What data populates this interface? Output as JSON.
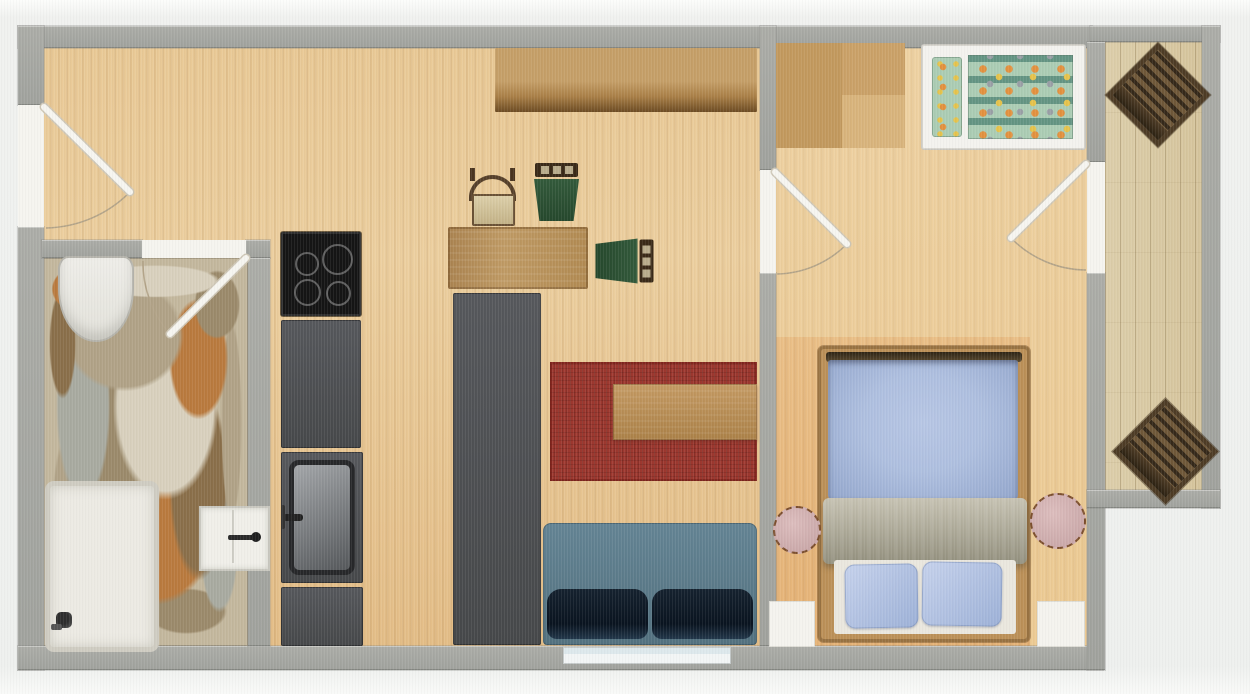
{
  "scene": {
    "type": "apartment-floor-plan",
    "width": 1250,
    "height": 694,
    "visible_text": "none"
  },
  "palette": {
    "floorA": "#e9c996",
    "floorB": "#e3bd87",
    "bedFloorA": "#eed2a3",
    "bedFloorB": "#ecca93",
    "rugOrangeA": "#eabf87",
    "rugOrangeB": "#e5b377",
    "balcony": "#d5c49c",
    "stoneBase": "#c3b79d",
    "st1": "#b0a287",
    "st2": "#9b8a6b",
    "st3": "#b97a3e",
    "st4": "#a8aaa0",
    "st5": "#d8d0bd",
    "st6": "#8a6f4a",
    "rugRed": "#9d382f",
    "bedFrame": "#bb9058",
    "duvetA": "#aebfdf",
    "duvetB": "#93a6cc",
    "nightOutline": "#7c4f2e",
    "childMint": "#abccb4",
    "childOrange": "#e2913f",
    "childYellow": "#e5c34c",
    "childGray": "#9aa0a6",
    "arc": "#b3a489"
  },
  "rooms": [
    {
      "name": "living-room-floor",
      "type": "floor-wood",
      "x": 42,
      "y": 48,
      "w": 718,
      "h": 598
    },
    {
      "name": "bathroom-floor",
      "type": "floor-stone",
      "x": 42,
      "y": 258,
      "w": 206,
      "h": 388
    },
    {
      "name": "bedroom-floor",
      "type": "floor-bedroom",
      "x": 776,
      "y": 42,
      "w": 311,
      "h": 604
    },
    {
      "name": "bedroom-rug",
      "type": "floor-orange",
      "x": 776,
      "y": 337,
      "w": 254,
      "h": 309
    },
    {
      "name": "balcony-floor",
      "type": "floor-balcony",
      "x": 1105,
      "y": 42,
      "w": 97,
      "h": 448
    }
  ],
  "walls": [
    {
      "name": "wall-top",
      "x": 18,
      "y": 26,
      "w": 1074,
      "h": 22
    },
    {
      "name": "wall-top-balcony",
      "x": 1090,
      "y": 26,
      "w": 130,
      "h": 16
    },
    {
      "name": "wall-left-upper",
      "x": 18,
      "y": 26,
      "w": 26,
      "h": 79
    },
    {
      "name": "wall-left-lower",
      "x": 18,
      "y": 227,
      "w": 26,
      "h": 443
    },
    {
      "name": "wall-bottom",
      "x": 18,
      "y": 646,
      "w": 1085,
      "h": 24
    },
    {
      "name": "wall-bathroom-top-left",
      "x": 42,
      "y": 240,
      "w": 100,
      "h": 18
    },
    {
      "name": "wall-bathroom-top-right",
      "x": 246,
      "y": 240,
      "w": 24,
      "h": 18
    },
    {
      "name": "wall-bathroom-right",
      "x": 248,
      "y": 258,
      "w": 22,
      "h": 388
    },
    {
      "name": "wall-bedroom-upper",
      "x": 760,
      "y": 26,
      "w": 16,
      "h": 144
    },
    {
      "name": "wall-bedroom-lower",
      "x": 760,
      "y": 273,
      "w": 16,
      "h": 373
    },
    {
      "name": "wall-balcony-upper",
      "x": 1087,
      "y": 42,
      "w": 18,
      "h": 120
    },
    {
      "name": "wall-balcony-lower",
      "x": 1087,
      "y": 273,
      "w": 18,
      "h": 397
    },
    {
      "name": "wall-balcony-right",
      "x": 1202,
      "y": 26,
      "w": 18,
      "h": 482
    },
    {
      "name": "wall-balcony-bottom",
      "x": 1087,
      "y": 490,
      "w": 133,
      "h": 18
    }
  ],
  "door_gaps": [
    {
      "name": "entrance-door-opening",
      "x": 18,
      "y": 105,
      "w": 26,
      "h": 122
    },
    {
      "name": "bathroom-door-opening",
      "x": 142,
      "y": 240,
      "w": 104,
      "h": 18
    },
    {
      "name": "bedroom-door-opening",
      "x": 760,
      "y": 170,
      "w": 16,
      "h": 103
    },
    {
      "name": "balcony-door-opening",
      "x": 1087,
      "y": 162,
      "w": 18,
      "h": 111
    }
  ],
  "windows": [
    {
      "name": "living-room-window",
      "type": "window",
      "x": 563,
      "y": 647,
      "w": 168,
      "h": 17
    },
    {
      "name": "bedroom-window-left",
      "type": "window-sq",
      "x": 769,
      "y": 601,
      "w": 46,
      "h": 46
    },
    {
      "name": "bedroom-window-right",
      "type": "window-sq",
      "x": 1037,
      "y": 601,
      "w": 48,
      "h": 46
    }
  ],
  "doors": [
    {
      "name": "entrance-door",
      "panel": [
        44,
        107,
        130,
        192
      ],
      "arc": "M130 192 A121 121 0 0 1 46 228"
    },
    {
      "name": "bathroom-door",
      "panel": [
        246,
        258,
        170,
        334
      ],
      "arc": "M170 334 A108 108 0 0 1 143 261"
    },
    {
      "name": "bedroom-door",
      "panel": [
        775,
        172,
        847,
        244
      ],
      "arc": "M847 244 A102 102 0 0 1 777 274"
    },
    {
      "name": "balcony-door",
      "panel": [
        1086,
        164,
        1011,
        238
      ],
      "arc": "M1011 238 A106 106 0 0 0 1086 270"
    }
  ],
  "furniture": [
    {
      "name": "wall-shelf",
      "type": "shelf",
      "x": 495,
      "y": 48,
      "w": 262,
      "h": 64
    },
    {
      "name": "dining-table",
      "type": "table",
      "x": 448,
      "y": 227,
      "w": 140,
      "h": 62
    },
    {
      "name": "dining-chair-beige",
      "type": "chair-beige",
      "x": 465,
      "y": 168,
      "w": 55,
      "h": 57
    },
    {
      "name": "dining-chair-green-1",
      "type": "chair-green",
      "x": 533,
      "y": 163,
      "w": 47,
      "h": 60,
      "rot": 0
    },
    {
      "name": "dining-chair-green-2",
      "type": "chair-green",
      "x": 593,
      "y": 237,
      "w": 60,
      "h": 47,
      "rot": 90
    },
    {
      "name": "cooktop",
      "type": "cooktop",
      "x": 281,
      "y": 232,
      "w": 80,
      "h": 84
    },
    {
      "name": "kitchen-counter-upper",
      "type": "counter",
      "x": 281,
      "y": 320,
      "w": 80,
      "h": 128
    },
    {
      "name": "kitchen-sink-counter",
      "type": "counter-sink",
      "x": 281,
      "y": 452,
      "w": 82,
      "h": 131
    },
    {
      "name": "kitchen-counter-lower",
      "type": "counter",
      "x": 281,
      "y": 587,
      "w": 82,
      "h": 59
    },
    {
      "name": "kitchen-island",
      "type": "island",
      "x": 453,
      "y": 293,
      "w": 88,
      "h": 352
    },
    {
      "name": "living-rug",
      "type": "rug-red",
      "x": 550,
      "y": 362,
      "w": 207,
      "h": 119
    },
    {
      "name": "coffee-table",
      "type": "coffee-table",
      "x": 613,
      "y": 384,
      "w": 144,
      "h": 56
    },
    {
      "name": "sofa",
      "type": "sofa",
      "x": 543,
      "y": 523,
      "w": 214,
      "h": 122
    },
    {
      "name": "toilet",
      "type": "toilet",
      "x": 58,
      "y": 256,
      "w": 72,
      "h": 82
    },
    {
      "name": "shower",
      "type": "shower",
      "x": 45,
      "y": 481,
      "w": 104,
      "h": 161
    },
    {
      "name": "bathroom-sink",
      "type": "bath-sink",
      "x": 199,
      "y": 506,
      "w": 67,
      "h": 61
    },
    {
      "name": "wardrobe",
      "type": "wardrobe",
      "x": 776,
      "y": 43,
      "w": 129,
      "h": 105
    },
    {
      "name": "child-bed",
      "type": "child-bed",
      "x": 922,
      "y": 45,
      "w": 163,
      "h": 104
    },
    {
      "name": "double-bed",
      "type": "bed",
      "x": 818,
      "y": 346,
      "w": 212,
      "h": 296
    },
    {
      "name": "nightstand-left",
      "type": "nightstand",
      "x": 773,
      "y": 506,
      "w": 48,
      "h": 48
    },
    {
      "name": "nightstand-right",
      "type": "nightstand",
      "x": 1030,
      "y": 493,
      "w": 56,
      "h": 56
    },
    {
      "name": "balcony-chair-top",
      "type": "balcony-chair",
      "x": 1106,
      "y": 42,
      "w": 94,
      "h": 96
    },
    {
      "name": "balcony-chair-bottom",
      "type": "balcony-chair",
      "x": 1112,
      "y": 398,
      "w": 96,
      "h": 96
    }
  ]
}
